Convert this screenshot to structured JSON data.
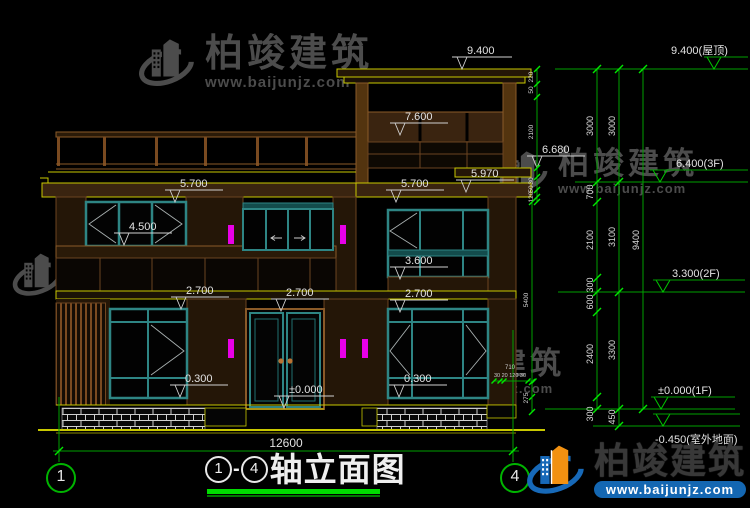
{
  "watermark": {
    "brand": "柏竣建筑",
    "url": "www.baijunjz.com"
  },
  "footer": {
    "brand": "柏竣建筑",
    "url": "www.baijunjz.com"
  },
  "title_block": {
    "axis_start": "1",
    "separator": "-",
    "axis_end": "4",
    "title": "轴立面图"
  },
  "axis_bubbles": {
    "left": "1",
    "right": "4"
  },
  "overall_dim": {
    "label": "12600",
    "x": 286,
    "y": 447,
    "y_line": 451,
    "x1": 59,
    "x2": 513
  },
  "elevation_markers": [
    {
      "label": "9.400",
      "tipx": 462,
      "tipy": 69,
      "lx1": 452,
      "lx2": 512
    },
    {
      "label": "7.600",
      "tipx": 400,
      "tipy": 135,
      "lx1": 390,
      "lx2": 448
    },
    {
      "label": "6.680",
      "tipx": 537,
      "tipy": 168,
      "lx1": 527,
      "lx2": 585
    },
    {
      "label": "5.970",
      "tipx": 466,
      "tipy": 192,
      "lx1": 456,
      "lx2": 514
    },
    {
      "label": "5.700",
      "tipx": 175,
      "tipy": 202,
      "lx1": 165,
      "lx2": 223
    },
    {
      "label": "5.700",
      "tipx": 396,
      "tipy": 202,
      "lx1": 386,
      "lx2": 444
    },
    {
      "label": "4.500",
      "tipx": 124,
      "tipy": 245,
      "lx1": 114,
      "lx2": 172
    },
    {
      "label": "3.600",
      "tipx": 400,
      "tipy": 279,
      "lx1": 390,
      "lx2": 448
    },
    {
      "label": "2.700",
      "tipx": 181,
      "tipy": 309,
      "lx1": 171,
      "lx2": 229
    },
    {
      "label": "2.700",
      "tipx": 281,
      "tipy": 311,
      "lx1": 271,
      "lx2": 329
    },
    {
      "label": "2.700",
      "tipx": 400,
      "tipy": 312,
      "lx1": 390,
      "lx2": 448
    },
    {
      "label": "0.300",
      "tipx": 180,
      "tipy": 397,
      "lx1": 170,
      "lx2": 228
    },
    {
      "label": "0.300",
      "tipx": 399,
      "tipy": 397,
      "lx1": 389,
      "lx2": 447
    },
    {
      "label": "±0.000",
      "tipx": 284,
      "tipy": 408,
      "lx1": 274,
      "lx2": 334
    }
  ],
  "level_markers_right": [
    {
      "label": "9.400(屋顶)",
      "y": 69,
      "x1": 555,
      "x2": 748,
      "tipx": 714,
      "textx": 671,
      "below": false
    },
    {
      "label": "6.400(3F)",
      "y": 182,
      "x1": 575,
      "x2": 748,
      "tipx": 660,
      "textx": 676,
      "below": false
    },
    {
      "label": "3.300(2F)",
      "y": 292,
      "x1": 558,
      "x2": 745,
      "tipx": 663,
      "textx": 672,
      "below": false
    },
    {
      "label": "±0.000(1F)",
      "y": 409,
      "x1": 545,
      "x2": 735,
      "tipx": 661,
      "textx": 658,
      "below": false
    },
    {
      "label": "-0.450(室外地面)",
      "y": 426,
      "x1": 593,
      "x2": 740,
      "tipx": 663,
      "textx": 655,
      "below": true
    }
  ],
  "chains": [
    {
      "x": 597,
      "small": false,
      "ticks": [
        69,
        182,
        202,
        278,
        292,
        312,
        397,
        409
      ],
      "labels": [
        {
          "t": "3000",
          "y": 126
        },
        {
          "t": "700",
          "y": 192
        },
        {
          "t": "2100",
          "y": 240
        },
        {
          "t": "300",
          "y": 285
        },
        {
          "t": "600",
          "y": 302
        },
        {
          "t": "2400",
          "y": 354
        },
        {
          "t": "300",
          "y": 414
        }
      ]
    },
    {
      "x": 619,
      "small": false,
      "ticks": [
        69,
        182,
        292,
        409,
        426
      ],
      "labels": [
        {
          "t": "3000",
          "y": 126
        },
        {
          "t": "3100",
          "y": 237
        },
        {
          "t": "3300",
          "y": 350
        },
        {
          "t": "450",
          "y": 417
        }
      ]
    },
    {
      "x": 643,
      "small": false,
      "ticks": [
        69,
        409
      ],
      "labels": [
        {
          "t": "9400",
          "y": 240
        }
      ]
    },
    {
      "x": 537,
      "small": true,
      "ticks": [
        69,
        84,
        97,
        168,
        177,
        190,
        197,
        202
      ],
      "labels": [
        {
          "t": "220",
          "y": 77
        },
        {
          "t": "50",
          "y": 90
        },
        {
          "t": "2100",
          "y": 132
        },
        {
          "t": "30",
          "y": 181
        },
        {
          "t": "50",
          "y": 189
        },
        {
          "t": "120",
          "y": 197
        }
      ]
    },
    {
      "x": 532,
      "small": true,
      "ticks": [
        202,
        397
      ],
      "labels": [
        {
          "t": "5400",
          "y": 300
        }
      ]
    },
    {
      "x": 532,
      "small": true,
      "ticks": [
        382,
        412
      ],
      "labels": [
        {
          "t": "275",
          "y": 398
        }
      ]
    }
  ],
  "tiny_dims": {
    "total": "710",
    "parts": "30 20 120 30",
    "x": 510,
    "y1": 369,
    "y2": 377,
    "tick_y": 381,
    "tick_xs": [
      494,
      500,
      504,
      528,
      534
    ]
  }
}
